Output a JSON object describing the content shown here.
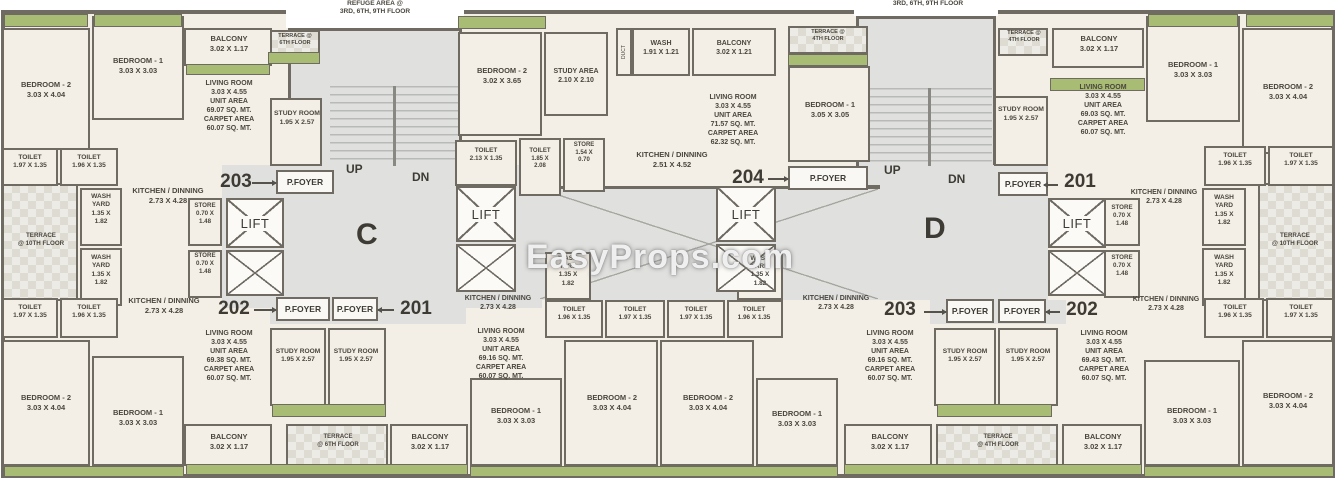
{
  "misc": {
    "p_foyer": "P.FOYER",
    "lift": "LIFT",
    "up": "UP",
    "dn": "DN",
    "wing_c": "C",
    "wing_d": "D",
    "refuge_left": "REFUGE AREA @\n3RD, 6TH, 9TH FLOOR",
    "refuge_right": "3RD, 6TH, 9TH FLOOR",
    "watermark": "EasyProps.com"
  },
  "units": {
    "u201": "201",
    "u202": "202",
    "u203": "203",
    "u204": "204"
  },
  "rooms": {
    "bed1_303": "BEDROOM - 1\n3.03 X 3.03",
    "bed1_305": "BEDROOM - 1\n3.05 X 3.05",
    "bed2_404": "BEDROOM - 2\n3.03 X 4.04",
    "bed2_365": "BEDROOM - 2\n3.02 X 3.65",
    "balcony_117": "BALCONY\n3.02 X 1.17",
    "balcony_121": "BALCONY\n3.02 X 1.21",
    "wash_191": "WASH\n1.91 X 1.21",
    "study_room": "STUDY ROOM\n1.95 X 2.57",
    "study_area": "STUDY AREA\n2.10 X 2.10",
    "kitchen_273": "KITCHEN / DINNING\n2.73 X 4.28",
    "kitchen_251": "KITCHEN / DINNING\n2.51 X 4.52",
    "toilet_196": "TOILET\n1.96 X 1.35",
    "toilet_197": "TOILET\n1.97 X 1.35",
    "toilet_213": "TOILET\n2.13 X 1.35",
    "toilet_185": "TOILET\n1.85 X\n2.08",
    "store_070": "STORE\n0.70 X\n1.48",
    "store_154": "STORE\n1.54 X\n0.70",
    "wash_yard": "WASH\nYARD\n1.35 X\n1.82",
    "terrace_10th": "TERRACE\n@ 10TH FLOOR",
    "terrace_6th": "TERRACE\n@ 6TH FLOOR",
    "terrace_6th_sm": "TERRACE @\n6TH FLOOR",
    "terrace_4th_sm": "TERRACE @\n4TH FLOOR",
    "terrace_4th": "TERRACE\n@ 4TH FLOOR",
    "living_6907": "LIVING ROOM\n3.03 X 4.55\nUNIT AREA\n69.07 SQ. MT.\nCARPET AREA\n60.07 SQ. MT.",
    "living_6938": "LIVING ROOM\n3.03 X 4.55\nUNIT AREA\n69.38 SQ. MT.\nCARPET AREA\n60.07 SQ. MT.",
    "living_6916": "LIVING ROOM\n3.03 X 4.55\nUNIT AREA\n69.16 SQ. MT.\nCARPET AREA\n60.07 SQ. MT.",
    "living_6903": "LIVING ROOM\n3.03 X 4.55\nUNIT AREA\n69.03 SQ. MT.\nCARPET AREA\n60.07 SQ. MT.",
    "living_6943": "LIVING ROOM\n3.03 X 4.55\nUNIT AREA\n69.43 SQ. MT.\nCARPET AREA\n60.07 SQ. MT.",
    "living_7157": "LIVING ROOM\n3.03 X 4.55\nUNIT AREA\n71.57 SQ. MT.\nCARPET AREA\n62.32 SQ. MT.",
    "duct": "DUCT"
  },
  "colors": {
    "wall": "#6f6b63",
    "room_fill": "#f4efe6",
    "corridor_fill": "#e0e1df",
    "green": "#a9bc74",
    "terrace_fill": "#eceae4",
    "text": "#4a463e"
  }
}
